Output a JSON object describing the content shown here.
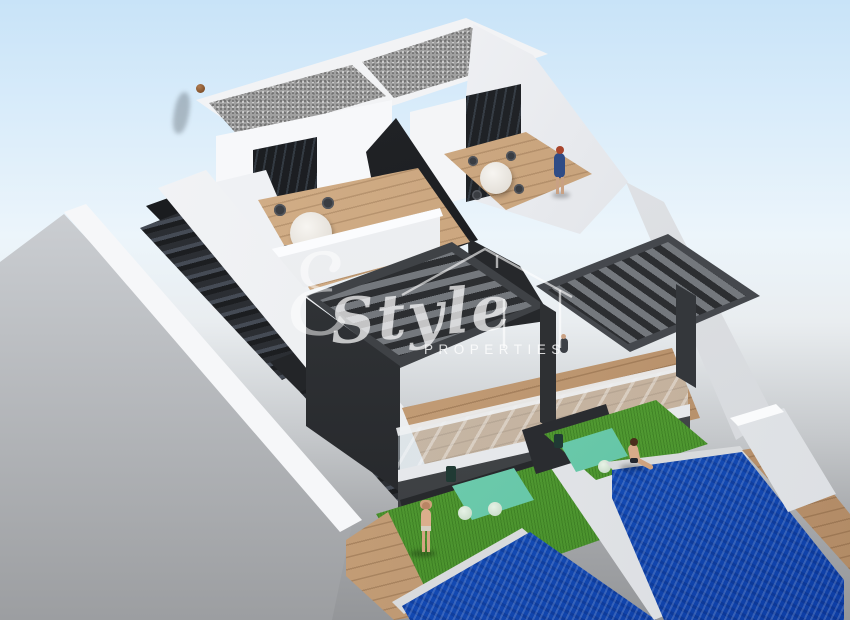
{
  "watermark": {
    "script_initial": "ℰ",
    "brand_script": "Style",
    "brand_sub": "PROPERTIES",
    "house_icon": "house-outline-icon"
  },
  "palette": {
    "sky_top": "#c8e3f8",
    "sky_horizon": "#ecf5fb",
    "ground_gray": "#949699",
    "wall_white": "#f5f6f8",
    "anthracite": "#3f4246",
    "dark_wall": "#1a1c1f",
    "gravel_gray": "#a0a0a0",
    "wood_deck": "#c29d79",
    "grass_green": "#4f9c33",
    "pool_blue": "#1d5ec9",
    "furniture_green_glass": "#6fcfb2"
  }
}
